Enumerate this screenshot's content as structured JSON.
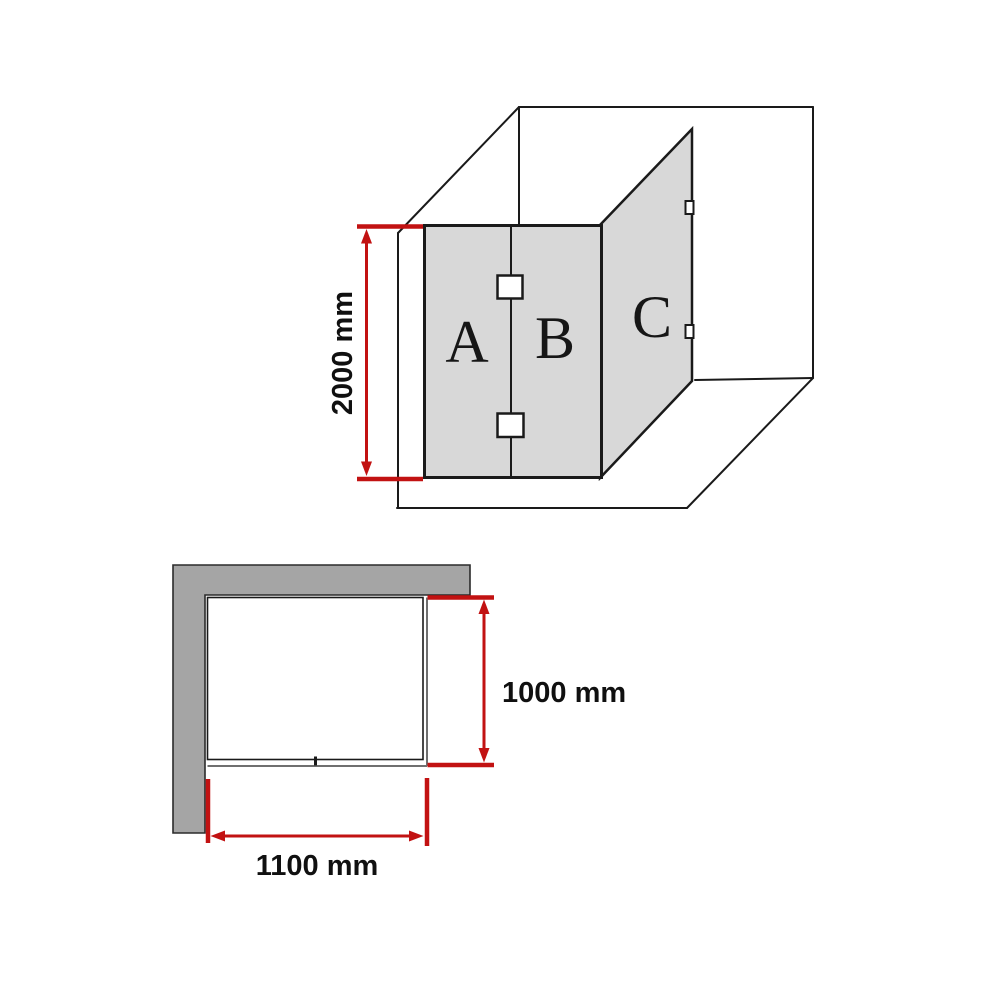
{
  "perspective_view": {
    "panels": [
      {
        "label": "A"
      },
      {
        "label": "B"
      },
      {
        "label": "C"
      }
    ],
    "height_dim": "2000 mm"
  },
  "plan_view": {
    "depth_dim": "1000 mm",
    "width_dim": "1100 mm"
  },
  "colors": {
    "dimension_red": "#c21212",
    "wall_gray": "#a5a5a5",
    "glass_gray": "#d8d8d8",
    "line_black": "#1a1a1a",
    "glass_plan_gray": "#6f6f6f"
  }
}
